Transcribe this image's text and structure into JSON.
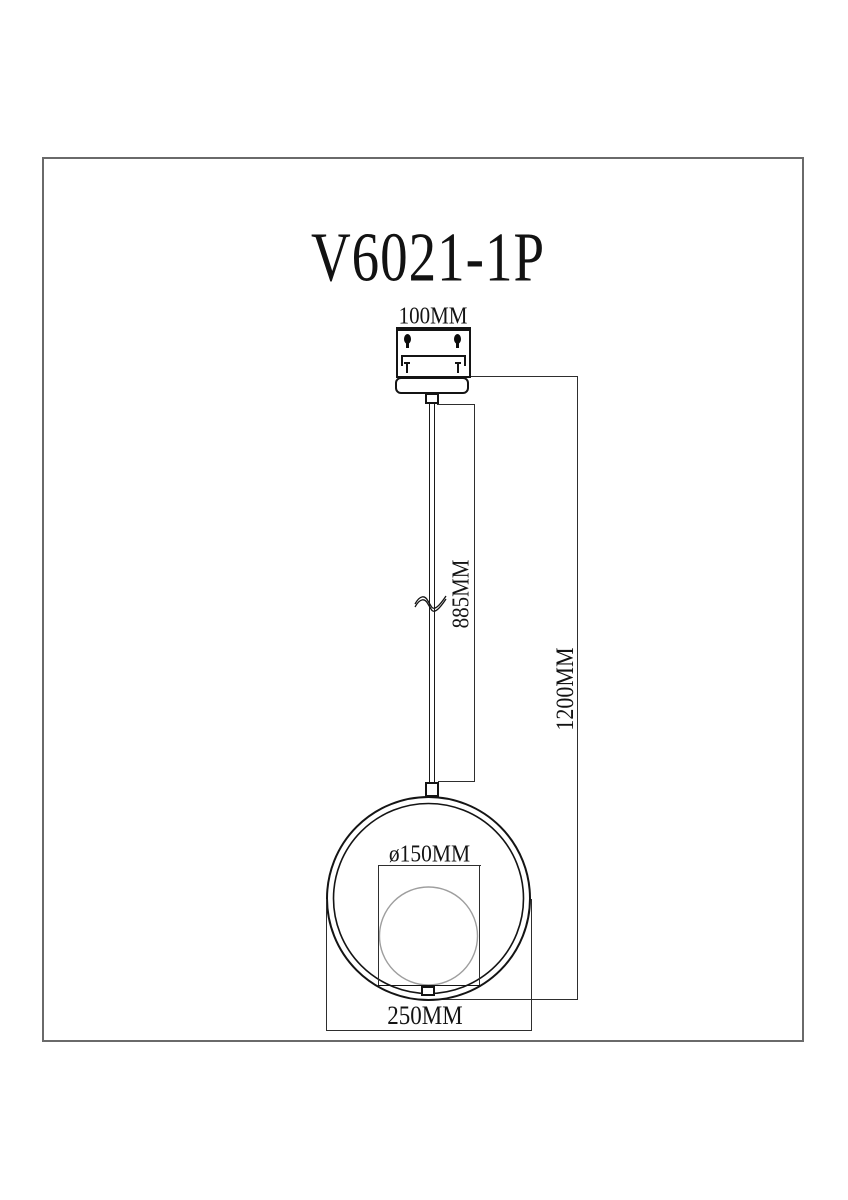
{
  "title": "V6021-1P",
  "dimensions": {
    "canopy_width": "100MM",
    "cord_length": "885MM",
    "total_height": "1200MM",
    "globe_diameter": "ø150MM",
    "ring_width": "250MM"
  },
  "colors": {
    "object_line": "#141414",
    "dimension_line": "#2e2e2e",
    "frame_border": "#6a6a6a",
    "globe_outline": "#9e9e9e",
    "background": "#ffffff"
  }
}
